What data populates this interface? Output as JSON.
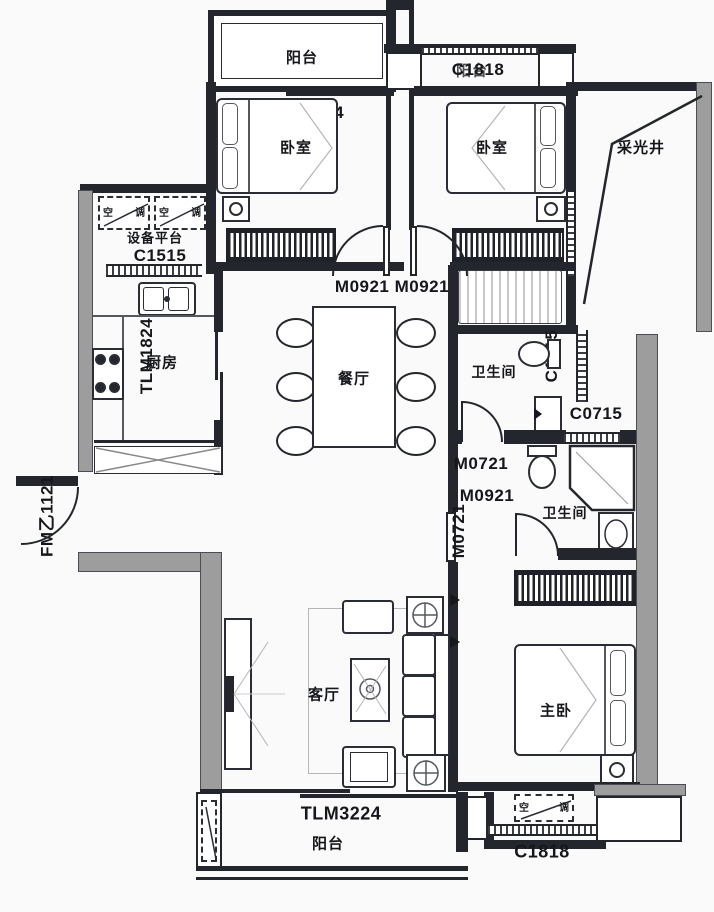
{
  "rooms": {
    "balcony_top": "阳台",
    "bedroom_left": "卧室",
    "bedroom_right": "卧室",
    "light_well": "采光井",
    "equipment_platform": "设备平台",
    "kitchen": "厨房",
    "dining": "餐厅",
    "bath1": "卫生间",
    "bath2": "卫生间",
    "living": "客厅",
    "master_bedroom": "主卧",
    "balcony_bottom": "阳台"
  },
  "codes": {
    "tlm1824_top": "TLM1824",
    "c1515": "C1515",
    "tlm1824_kitchen": "TLM1824",
    "m0921_pair": "M0921 M0921",
    "c1015": "C1015",
    "c0715": "C0715",
    "m0721": "M0721",
    "m0921": "M0921",
    "m0721_vert": "M0721",
    "fm1121": "FM乙1121",
    "tlm3224": "TLM3224",
    "c1818_top": "C1818",
    "c1818_top_overlay": "阳台",
    "c1818_bottom": "C1818"
  },
  "ac_marker": {
    "left_glyph": "空",
    "right_glyph": "调"
  }
}
